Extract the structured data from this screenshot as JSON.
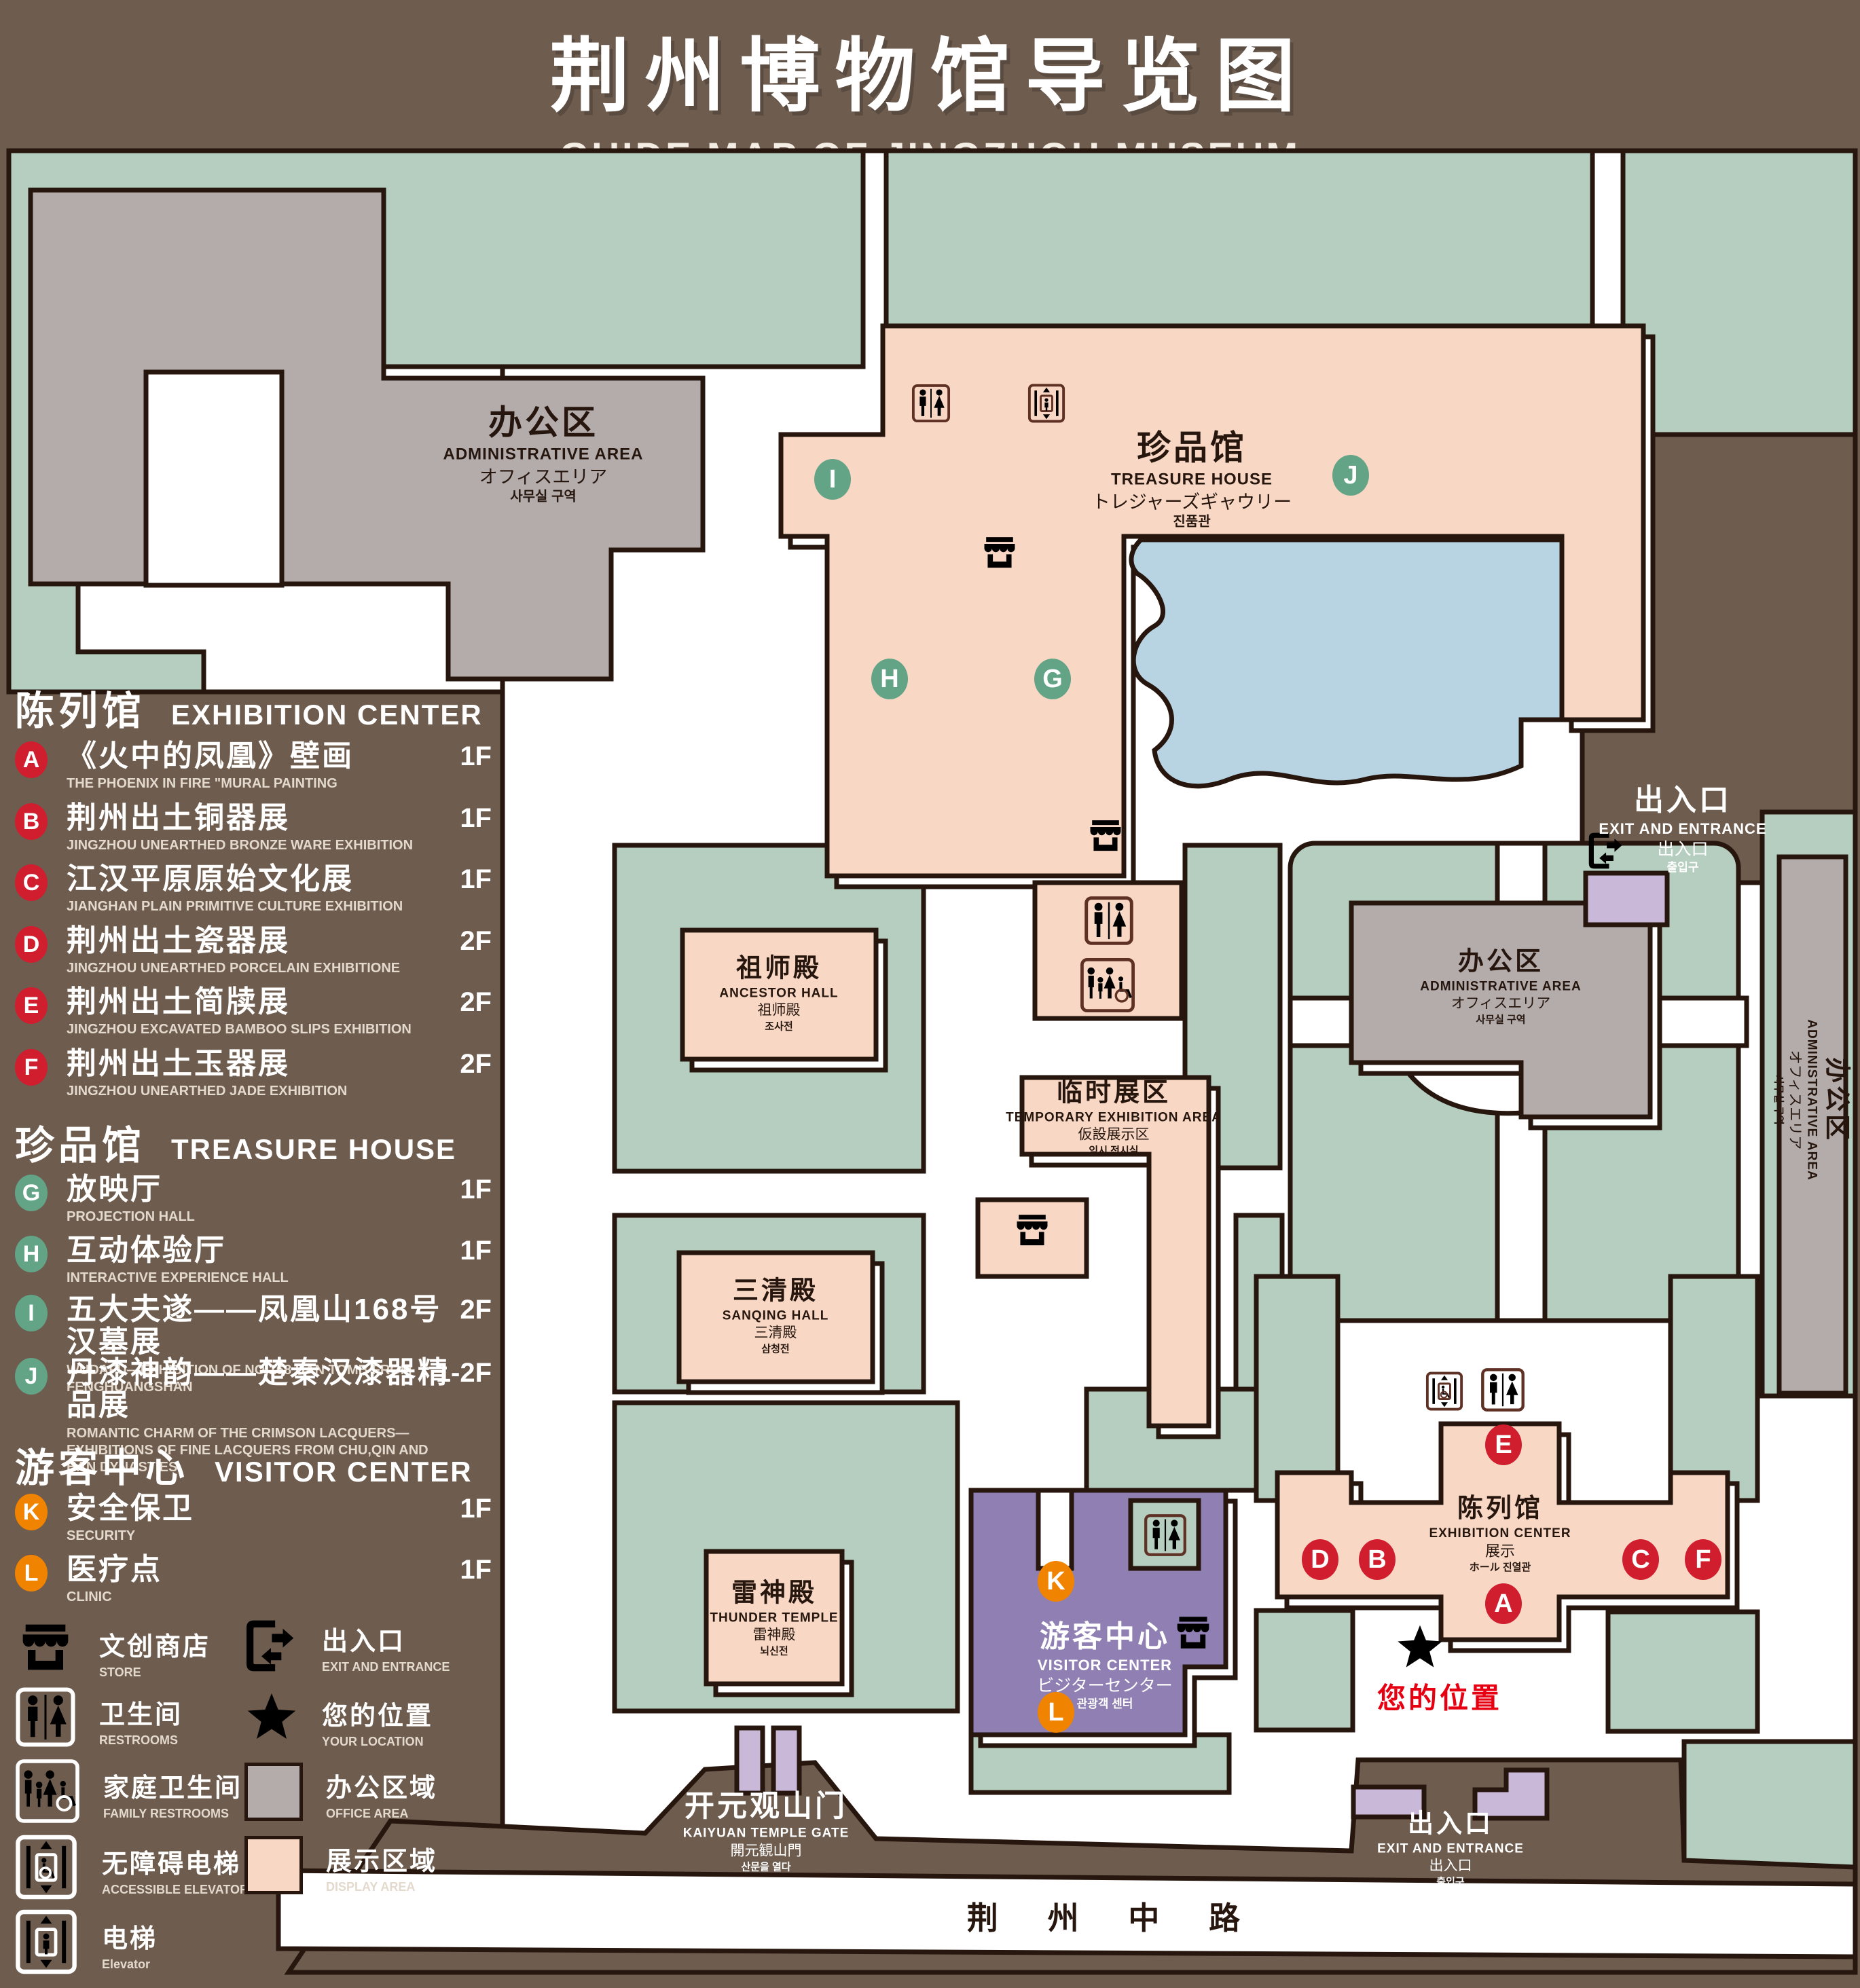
{
  "title": {
    "zh": "荆州博物馆导览图",
    "en": "GUIDE MAP OF JINGZHOU MUSEUM"
  },
  "colors": {
    "background": "#6e5c4f",
    "courtyard_green": "#b6cec0",
    "display_pink": "#f8d8c5",
    "office_gray": "#b3acab",
    "pond_blue": "#b8d3e2",
    "visitor_purple": "#8f7fb3",
    "gate_purple": "#c9b8d8",
    "badge_red": "#d01e2f",
    "badge_green": "#63a386",
    "badge_orange": "#f08300",
    "icon_brown": "#5e3124",
    "location_red": "#e60012",
    "outline": "#26160e"
  },
  "legend": {
    "sections": [
      {
        "zh": "陈列馆",
        "en": "EXHIBITION CENTER",
        "items": [
          {
            "id": "A",
            "zh": "《火中的凤凰》壁画",
            "en": "THE PHOENIX IN FIRE \"MURAL PAINTING",
            "floor": "1F"
          },
          {
            "id": "B",
            "zh": "荆州出土铜器展",
            "en": "JINGZHOU UNEARTHED BRONZE WARE EXHIBITION",
            "floor": "1F"
          },
          {
            "id": "C",
            "zh": "江汉平原原始文化展",
            "en": "JIANGHAN PLAIN PRIMITIVE CULTURE EXHIBITION",
            "floor": "1F"
          },
          {
            "id": "D",
            "zh": "荆州出土瓷器展",
            "en": "JINGZHOU UNEARTHED PORCELAIN EXHIBITIONE",
            "floor": "2F"
          },
          {
            "id": "E",
            "zh": "荆州出土简牍展",
            "en": "JINGZHOU EXCAVATED BAMBOO SLIPS EXHIBITION",
            "floor": "2F"
          },
          {
            "id": "F",
            "zh": "荆州出土玉器展",
            "en": "JINGZHOU UNEARTHED JADE EXHIBITION",
            "floor": "2F"
          }
        ]
      },
      {
        "zh": "珍品馆",
        "en": "TREASURE HOUSE",
        "items": [
          {
            "id": "G",
            "zh": "放映厅",
            "en": "PROJECTION HALL",
            "floor": "1F"
          },
          {
            "id": "H",
            "zh": "互动体验厅",
            "en": "INTERACTIVE EXPERIENCE HALL",
            "floor": "1F"
          },
          {
            "id": "I",
            "zh": "五大夫遂——凤凰山168号汉墓展",
            "en": "WUDAFU—EXHIBITION OF NO.168 HAN TOMB FROM FENGHUANGSHAN",
            "floor": "2F"
          },
          {
            "id": "J",
            "zh": "丹漆神韵——楚秦汉漆器精品展",
            "en": "ROMANTIC CHARM OF THE CRIMSON LACQUERS—EXHIBITIONS OF FINE LACQUERS FROM CHU,QIN AND HAN DYNASTIES",
            "floor": "1-2F"
          }
        ]
      },
      {
        "zh": "游客中心",
        "en": "VISITOR CENTER",
        "items": [
          {
            "id": "K",
            "zh": "安全保卫",
            "en": "SECURITY",
            "floor": "1F"
          },
          {
            "id": "L",
            "zh": "医疗点",
            "en": "CLINIC",
            "floor": "1F"
          }
        ]
      }
    ],
    "symbols": [
      {
        "zh": "文创商店",
        "en": "STORE"
      },
      {
        "zh": "出入口",
        "en": "EXIT AND ENTRANCE"
      },
      {
        "zh": "卫生间",
        "en": "RESTROOMS"
      },
      {
        "zh": "您的位置",
        "en": "YOUR LOCATION"
      },
      {
        "zh": "家庭卫生间",
        "en": "FAMILY RESTROOMS"
      },
      {
        "zh": "办公区域",
        "en": "OFFICE AREA"
      },
      {
        "zh": "无障碍电梯",
        "en": "ACCESSIBLE ELEVATOR"
      },
      {
        "zh": "展示区域",
        "en": "DISPLAY AREA"
      },
      {
        "zh": "电梯",
        "en": "Elevator"
      }
    ]
  },
  "map": {
    "labels": {
      "admin": {
        "lines": [
          "办公区",
          "ADMINISTRATIVE AREA",
          "オフィスエリア",
          "사무실 구역"
        ]
      },
      "treasure": {
        "lines": [
          "珍品馆",
          "TREASURE HOUSE",
          "トレジャーズギャウリー",
          "진품관"
        ]
      },
      "exit": {
        "lines": [
          "出入口",
          "EXIT AND ENTRANCE",
          "出入口",
          "출입구"
        ]
      },
      "ancestor": {
        "lines": [
          "祖师殿",
          "ANCESTOR HALL",
          "祖师殿",
          "조사전"
        ]
      },
      "temporary": {
        "lines": [
          "临时展区",
          "TEMPORARY EXHIBITION AREA",
          "仮設展示区",
          "임시 전시실"
        ]
      },
      "sanqing": {
        "lines": [
          "三清殿",
          "SANQING HALL",
          "三清殿",
          "삼청전"
        ]
      },
      "thunder": {
        "lines": [
          "雷神殿",
          "THUNDER TEMPLE",
          "雷神殿",
          "뇌신전"
        ]
      },
      "visitor": {
        "lines": [
          "游客中心",
          "VISITOR CENTER",
          "ビジターセンター",
          "관광객 센터"
        ]
      },
      "exhibition": {
        "lines": [
          "陈列馆",
          "EXHIBITION CENTER",
          "展示",
          "ホール 진열관"
        ]
      },
      "gate": {
        "lines": [
          "开元观山门",
          "KAIYUAN TEMPLE GATE",
          "開元観山門",
          "산문을 열다"
        ]
      }
    },
    "road": "荆 州 中 路",
    "your_location": "您的位置"
  }
}
